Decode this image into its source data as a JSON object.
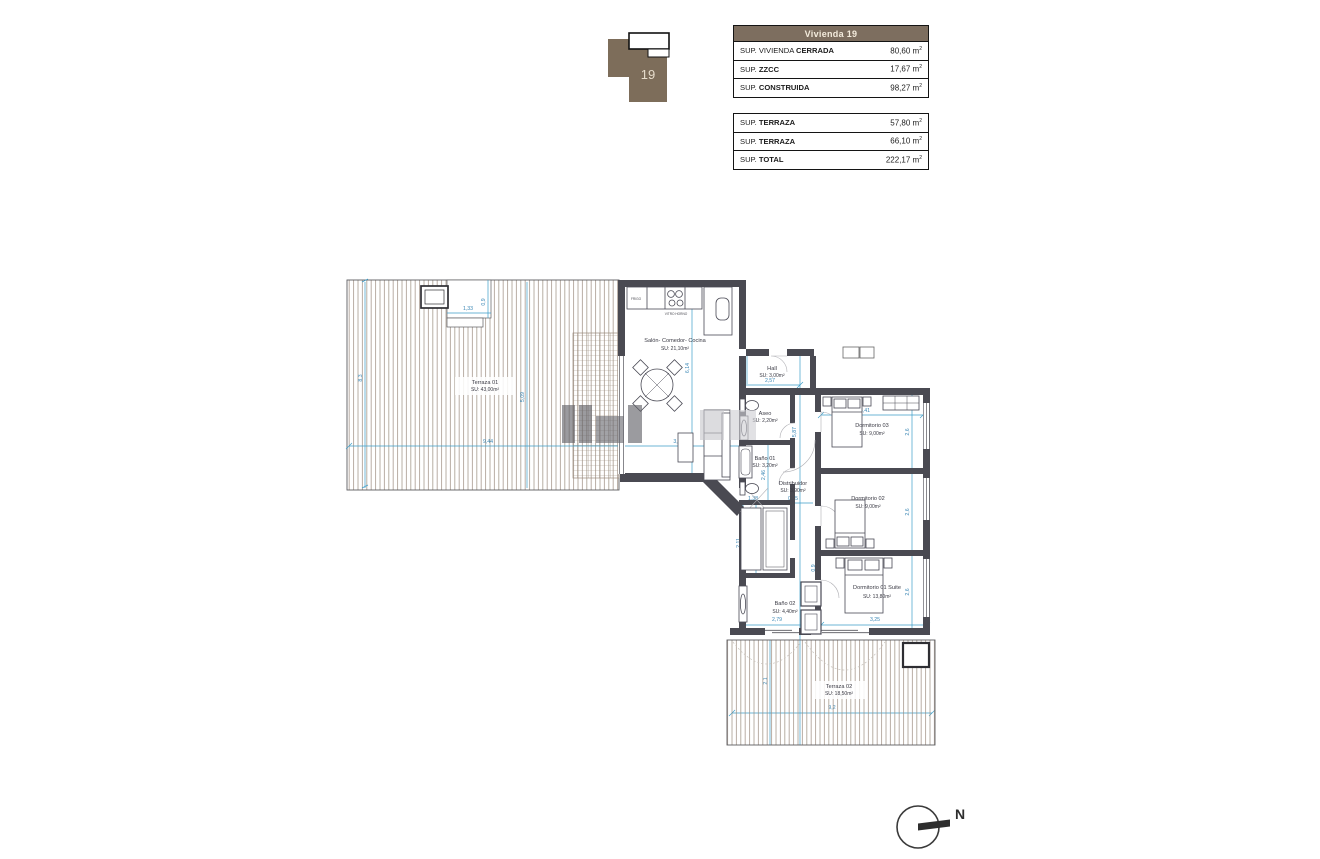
{
  "key_plan": {
    "unit": "19",
    "fill": "#7d6d5a"
  },
  "summary": {
    "header": {
      "title": "Vivienda 19",
      "bg": "#7d6e5f"
    },
    "closed": {
      "rows": [
        {
          "prefix": "SUP. VIVIENDA ",
          "bold": "CERRADA",
          "value": "80,60",
          "unit": "m",
          "exp": "2"
        },
        {
          "prefix": "SUP. ",
          "bold": "ZZCC",
          "value": "17,67",
          "unit": "m",
          "exp": "2"
        },
        {
          "prefix": "SUP. ",
          "bold": "CONSTRUIDA",
          "value": "98,27",
          "unit": "m",
          "exp": "2"
        }
      ]
    },
    "terraces": {
      "rows": [
        {
          "prefix": "SUP. ",
          "bold": "TERRAZA",
          "value": "57,80",
          "unit": "m",
          "exp": "2"
        },
        {
          "prefix": "SUP. ",
          "bold": "TERRAZA",
          "value": "66,10",
          "unit": "m",
          "exp": "2"
        },
        {
          "prefix": "SUP. ",
          "bold": "TOTAL",
          "value": "222,17",
          "unit": "m",
          "exp": "2"
        }
      ]
    }
  },
  "plan": {
    "rooms": {
      "salon": {
        "name": "Salón- Comedor- Cocina",
        "area": "SU: 21,10m²"
      },
      "hall": {
        "name": "Hall",
        "area": "SU: 3,00m²"
      },
      "aseo": {
        "name": "Aseo",
        "area": "SU: 2,20m²"
      },
      "bano01": {
        "name": "Baño 01",
        "area": "SU: 3,20m²"
      },
      "distribuidor": {
        "name": "Distribuidor",
        "area": "SU: 3,90m²"
      },
      "dorm03": {
        "name": "Dormitorio 03",
        "area": "SU: 9,00m²"
      },
      "dorm02": {
        "name": "Dormitorio 02",
        "area": "SU: 9,00m²"
      },
      "dorm01": {
        "name": "Dormitorio 01 Suite",
        "area": "SU: 13,80m²"
      },
      "bano02": {
        "name": "Baño 02",
        "area": "SU: 4,40m²"
      },
      "terraza01": {
        "name": "Terraza 01",
        "area": "SU: 43,00m²"
      },
      "terraza02": {
        "name": "Terraza 02",
        "area": "SU: 18,50m²"
      }
    },
    "kitchen": {
      "fridge": "FRIGO",
      "hob": "VITRO HORNO"
    },
    "dims": {
      "t1_notch_w": "1,33",
      "t1_notch_h": "0,9",
      "t1_h": "8,3",
      "t1_w": "9,44",
      "t1_mid": "5,09",
      "salon_h": "6,14",
      "salon_w": "3,5",
      "hall_h": "1,2",
      "hall_w": "2,57",
      "corridor_h": "5,87",
      "d03_w": "3,41",
      "d03_h": "2,6",
      "bano01_h": "2,46",
      "dist_w1": "1,38",
      "dist_w2": "0,95",
      "closet_h1": "2,11",
      "closet_h2": "0,91",
      "corridor_s": "0,9",
      "bano02_w": "2,79",
      "d01_w": "3,25",
      "d02_h": "2,6",
      "d01_h": "2,6",
      "t2_w": "9,2",
      "t2_h": "2,1"
    },
    "north_label": "N",
    "colors": {
      "wall": "#4a4a52",
      "dimension": "#3d9ec9",
      "hatch": "#9a8b7d",
      "accent_brown": "#7d6e5f"
    }
  }
}
